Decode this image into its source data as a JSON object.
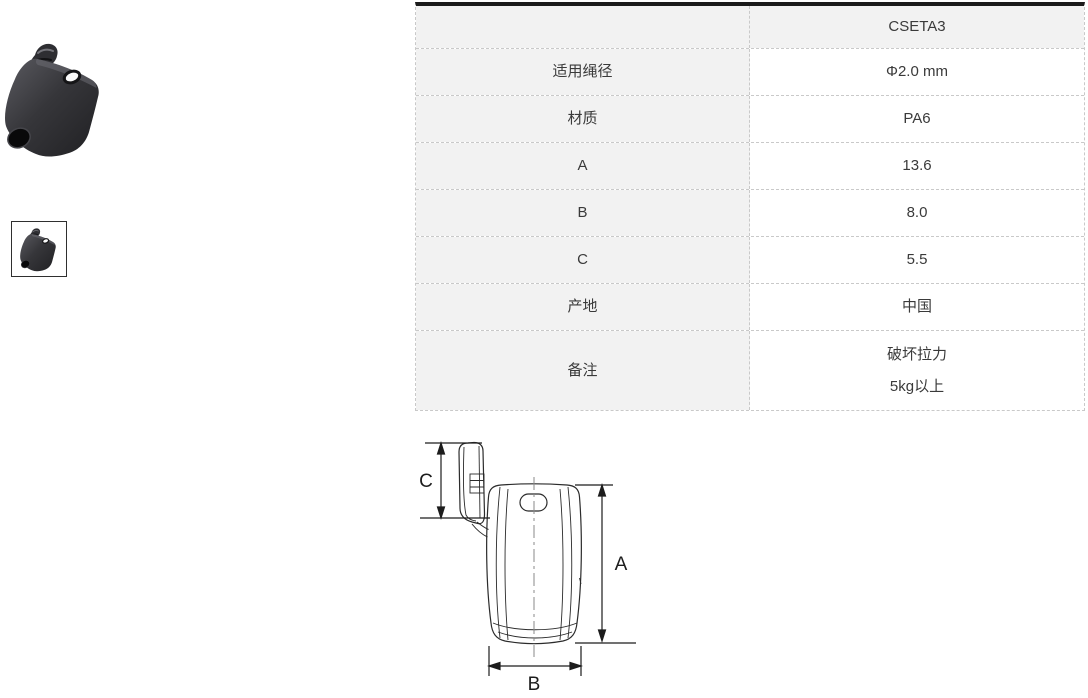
{
  "product": {
    "photo_name": "cord-lock-product-photo",
    "thumbnail_name": "product-thumbnail"
  },
  "spec_table": {
    "model_header": "CSETA3",
    "rows": [
      {
        "label": "适用绳径",
        "value": "Φ2.0 mm"
      },
      {
        "label": "材质",
        "value": "PA6"
      },
      {
        "label": "A",
        "value": "13.6"
      },
      {
        "label": "B",
        "value": "8.0"
      },
      {
        "label": "C",
        "value": "5.5"
      },
      {
        "label": "产地",
        "value": "中国"
      },
      {
        "label": "备注",
        "value": "破坏拉力",
        "value_line2": "5kg以上"
      }
    ]
  },
  "diagram": {
    "dim_labels": {
      "a": "A",
      "b": "B",
      "c": "C"
    }
  },
  "colors": {
    "table_top_bar": "#1b1b1b",
    "cell_shaded": "#f2f2f2",
    "cell_plain": "#ffffff",
    "dashed_border": "#c9c9c9",
    "text_primary": "#3a3a3a",
    "drawing_line": "#2b2b2b",
    "product_body_dark": "#2c2c30"
  }
}
